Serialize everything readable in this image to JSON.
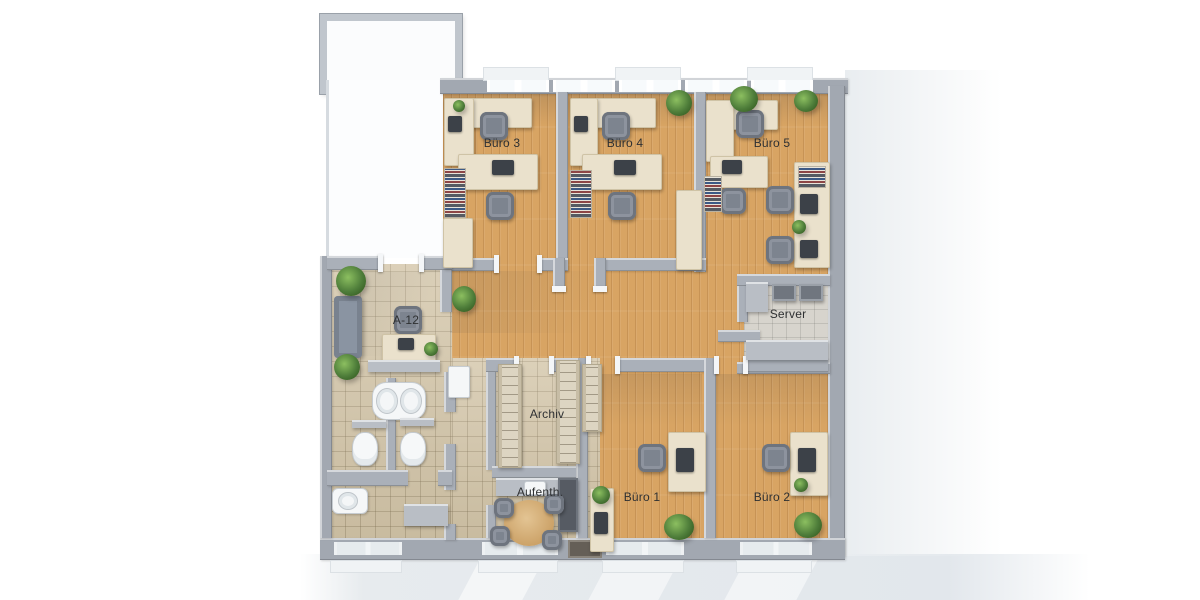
{
  "scene": {
    "description": "3D top-down office floor plan rendering"
  },
  "rooms": {
    "buero3": {
      "label": "Büro 3"
    },
    "buero4": {
      "label": "Büro 4"
    },
    "buero5": {
      "label": "Büro 5"
    },
    "server": {
      "label": "Server"
    },
    "a12": {
      "label": "A-12"
    },
    "archiv": {
      "label": "Archiv"
    },
    "aufenthalt": {
      "label": "Aufenth."
    },
    "buero1": {
      "label": "Büro 1"
    },
    "buero2": {
      "label": "Büro 2"
    }
  },
  "colors": {
    "wood_floor": "#d8a463",
    "tile_floor": "#d3c5a8",
    "server_tile": "#d7d4cd",
    "wall": "#aab0b9",
    "desk": "#eae1cc",
    "chair": "#8d939e",
    "plant": "#4e7d3a",
    "background": "#ffffff"
  }
}
